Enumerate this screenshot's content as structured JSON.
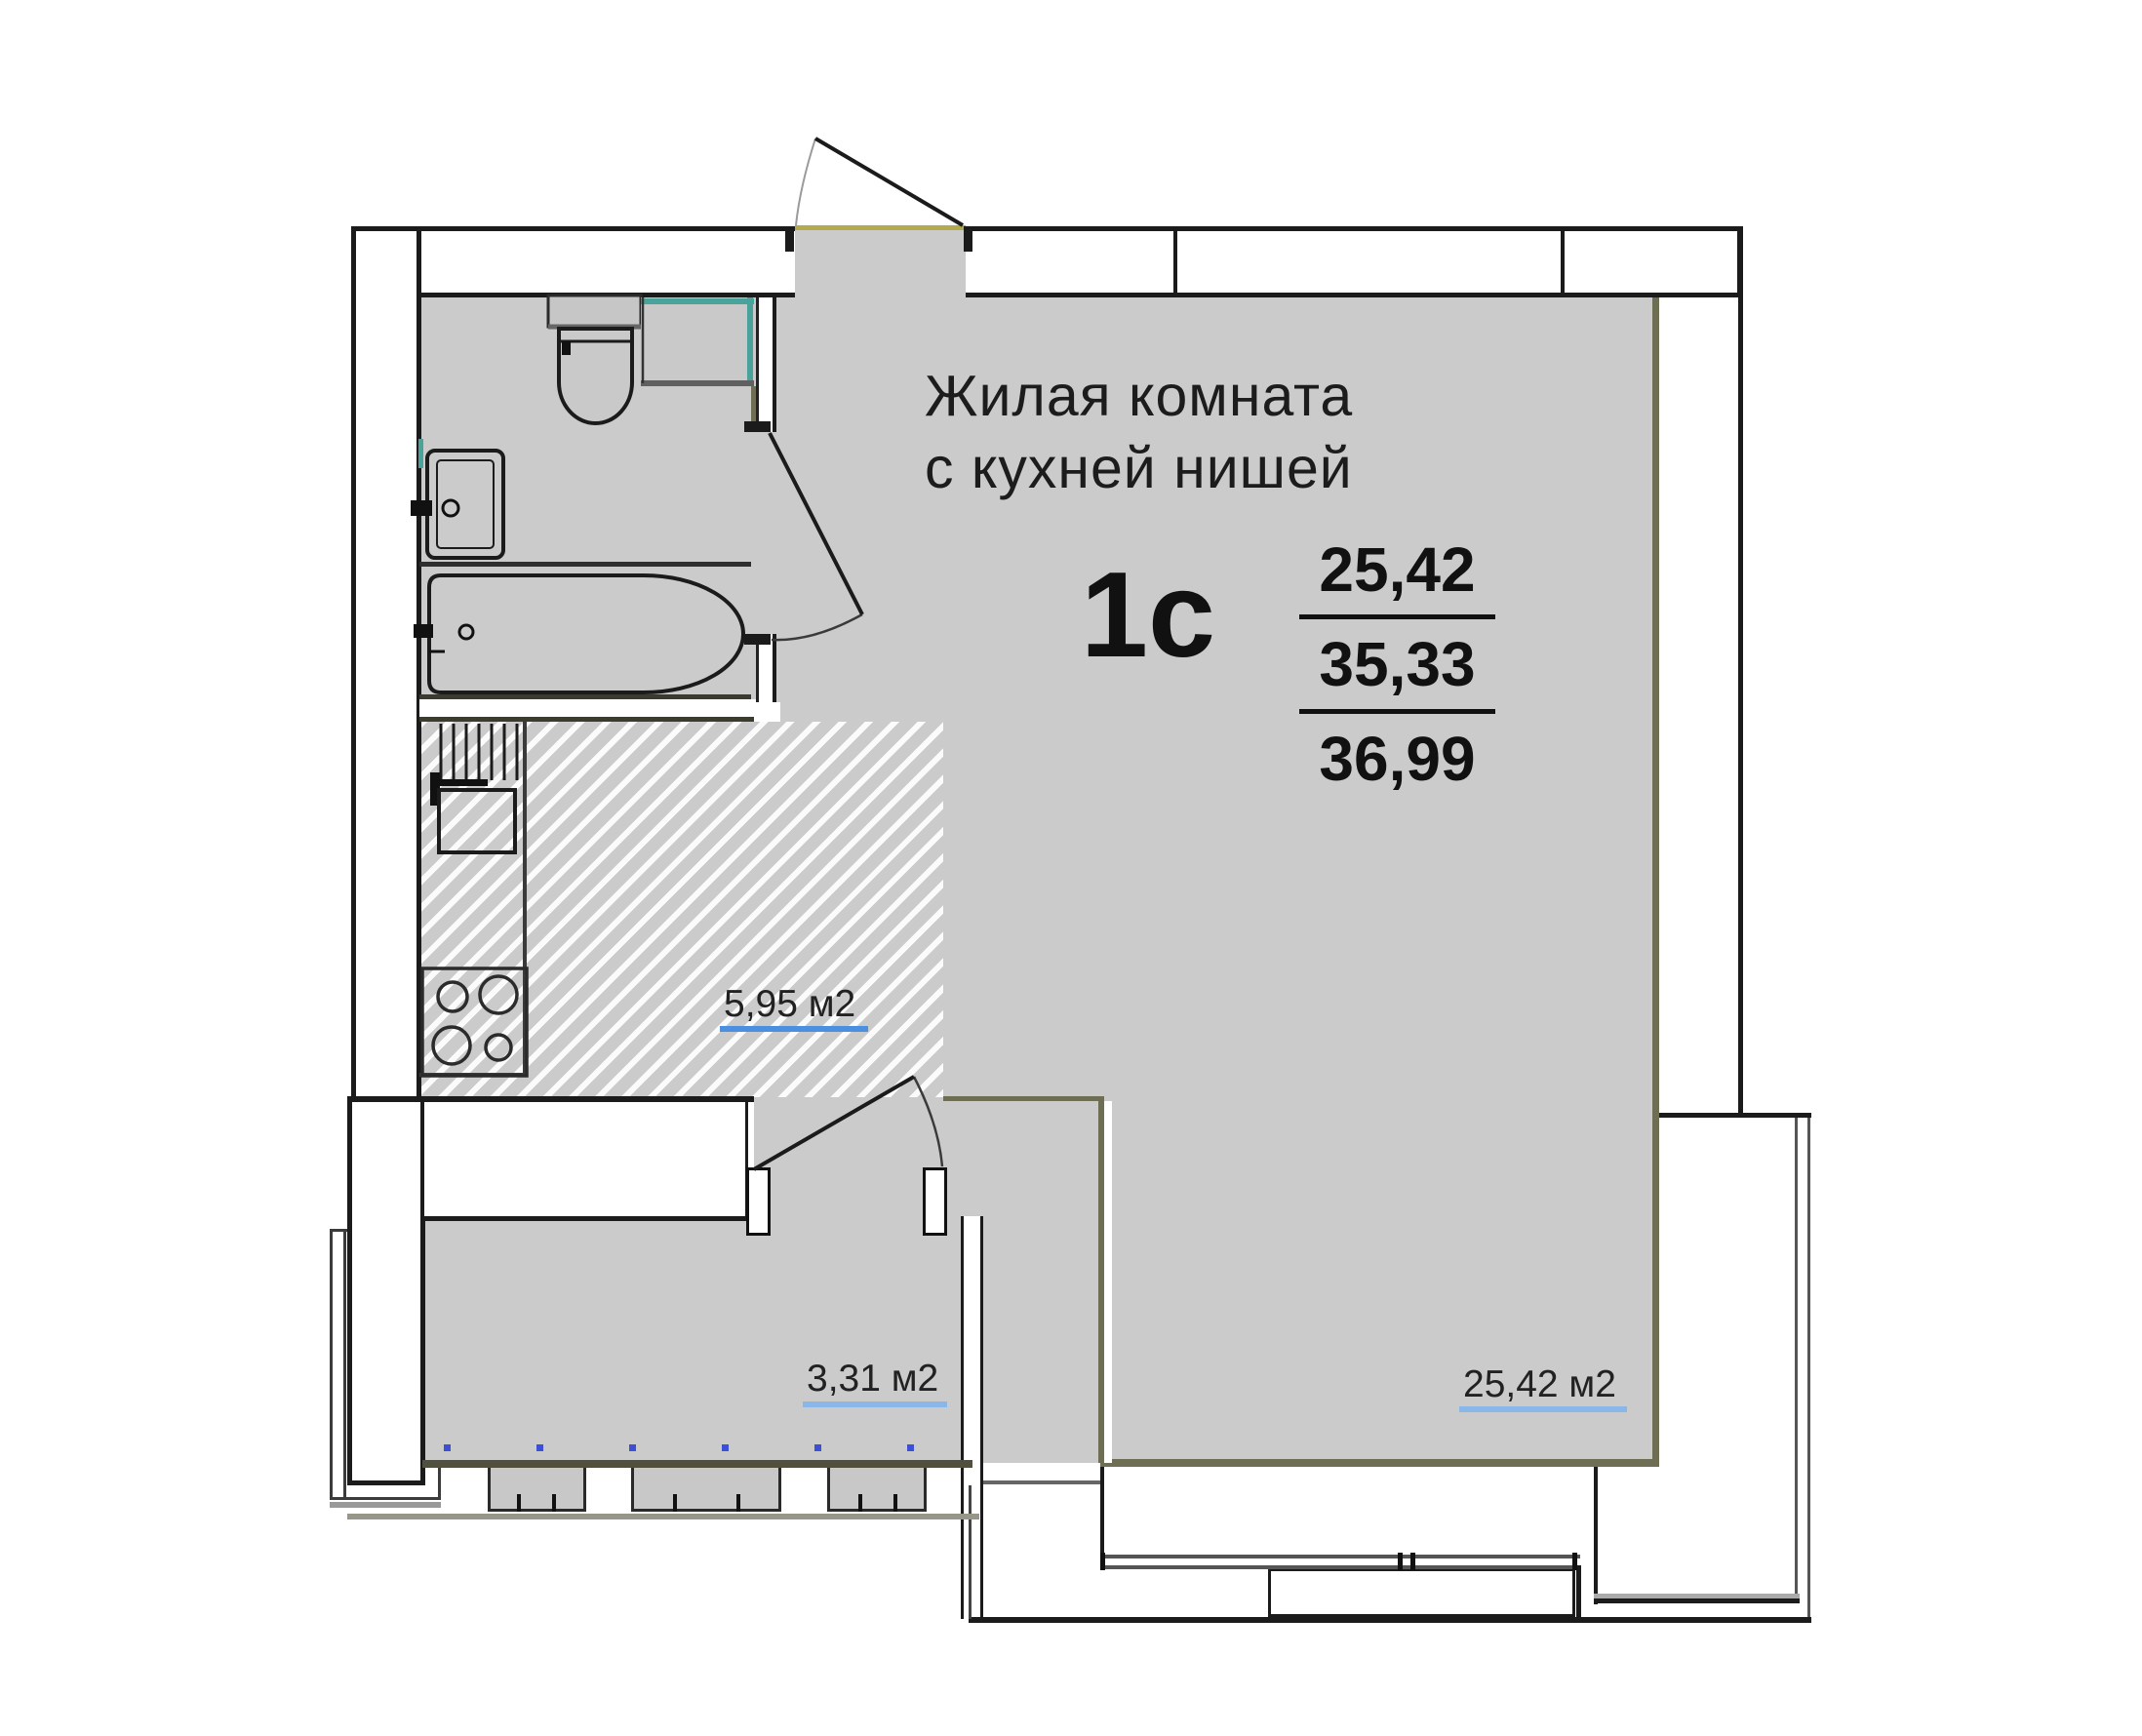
{
  "floor_plan": {
    "room_label": {
      "line1": "Жилая комната",
      "line2": "с кухней нишей"
    },
    "apartment": {
      "type_code": "1с",
      "area_living": "25,42",
      "area_main": "35,33",
      "area_total": "36,99"
    },
    "room_areas": {
      "kitchen_niche": "5,95 м2",
      "loggia": "3,31 м2",
      "living_room": "25,42 м2"
    },
    "colors": {
      "floor_gray": "#cbcbcb",
      "wall_black": "#1b1b1b",
      "accent_olive": "#6e6e54",
      "accent_teal": "#4aa39a",
      "threshold_yellow": "#b3aa4e",
      "link_blue_bright": "#4a8fe0",
      "link_blue_light": "#8ab7ea",
      "dot_blue": "#3b4fd8"
    }
  }
}
